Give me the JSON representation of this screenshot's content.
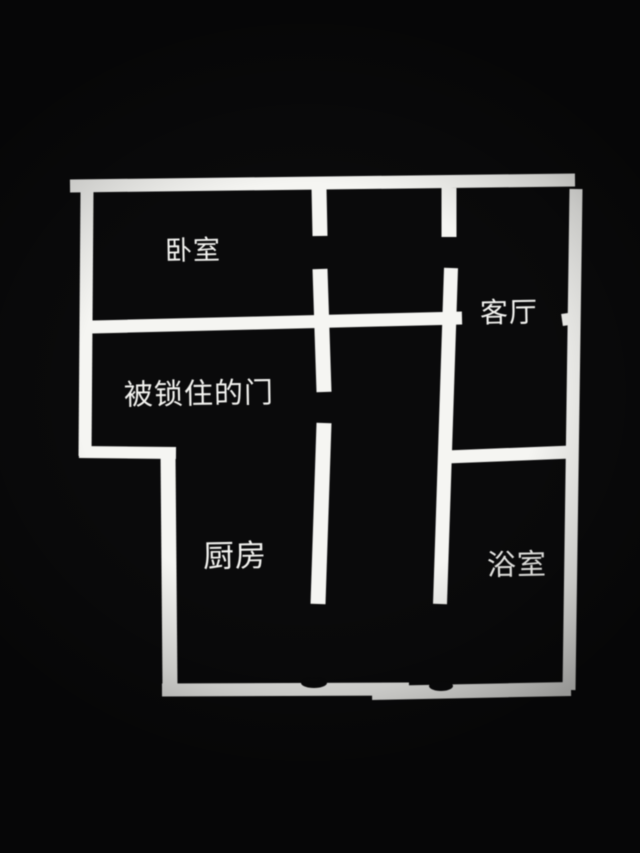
{
  "image": {
    "kind": "floor-plan-photo",
    "width": 640,
    "height": 853,
    "background_color": "#0a0a0b",
    "wall_color": "#f5f5f2",
    "text_color": "#f3f3f0"
  },
  "floor_plan": {
    "rooms": [
      {
        "id": "bedroom",
        "label": "卧室",
        "x": 193,
        "y": 251,
        "font_size": 27
      },
      {
        "id": "living-room",
        "label": "客厅",
        "x": 509,
        "y": 313,
        "font_size": 28
      },
      {
        "id": "locked-door",
        "label": "被锁住的门",
        "x": 199,
        "y": 395,
        "font_size": 29
      },
      {
        "id": "kitchen",
        "label": "厨房",
        "x": 235,
        "y": 556,
        "font_size": 31
      },
      {
        "id": "bathroom",
        "label": "浴室",
        "x": 517,
        "y": 566,
        "font_size": 29
      }
    ],
    "walls": [
      {
        "name": "outer-wall-top",
        "x1": 70,
        "y1": 186,
        "x2": 575,
        "y2": 180,
        "t": 13
      },
      {
        "name": "outer-wall-left",
        "x1": 87,
        "y1": 190,
        "x2": 85,
        "y2": 456,
        "t": 13
      },
      {
        "name": "outer-wall-right",
        "x1": 576,
        "y1": 189,
        "x2": 569,
        "y2": 690,
        "t": 13
      },
      {
        "name": "living-room-wall-stub",
        "x1": 562,
        "y1": 320,
        "x2": 569,
        "y2": 319,
        "t": 12
      },
      {
        "name": "bedroom-east-wall-upper",
        "x1": 319,
        "y1": 188,
        "x2": 320,
        "y2": 236,
        "t": 15
      },
      {
        "name": "bedroom-east-wall-mid",
        "x1": 320,
        "y1": 269,
        "x2": 324,
        "y2": 392,
        "t": 15
      },
      {
        "name": "bedroom-east-wall-lower",
        "x1": 324,
        "y1": 423,
        "x2": 318,
        "y2": 604,
        "t": 15
      },
      {
        "name": "hall-east-wall-upper",
        "x1": 449,
        "y1": 188,
        "x2": 449,
        "y2": 237,
        "t": 15
      },
      {
        "name": "hall-east-wall-lower",
        "x1": 451,
        "y1": 268,
        "x2": 440,
        "y2": 604,
        "t": 14
      },
      {
        "name": "bedroom-south-wall",
        "x1": 92,
        "y1": 327,
        "x2": 462,
        "y2": 318,
        "t": 13
      },
      {
        "name": "locked-room-south-wall",
        "x1": 79,
        "y1": 452,
        "x2": 176,
        "y2": 453,
        "t": 12
      },
      {
        "name": "kitchen-west-wall",
        "x1": 168,
        "y1": 453,
        "x2": 170,
        "y2": 688,
        "t": 15
      },
      {
        "name": "living-bath-divider-wall",
        "x1": 446,
        "y1": 457,
        "x2": 572,
        "y2": 452,
        "t": 13
      },
      {
        "name": "bottom-wall-left-segment",
        "x1": 162,
        "y1": 690,
        "x2": 409,
        "y2": 689,
        "t": 13
      },
      {
        "name": "bottom-wall-right-segment",
        "x1": 372,
        "y1": 693,
        "x2": 571,
        "y2": 689,
        "t": 14
      }
    ],
    "wall_notches": [
      {
        "name": "bottom-wall-notch-left",
        "cx": 314,
        "cy": 683,
        "rx": 13,
        "ry": 5
      },
      {
        "name": "bottom-wall-notch-right",
        "cx": 441,
        "cy": 686,
        "rx": 12,
        "ry": 5
      }
    ],
    "door_openings": [
      {
        "name": "bedroom-door-gap",
        "wall": "bedroom-east-wall",
        "from_y": 236,
        "to_y": 269
      },
      {
        "name": "living-room-door-gap",
        "wall": "hall-east-wall",
        "from_y": 237,
        "to_y": 268
      },
      {
        "name": "locked-door-gap",
        "wall": "bedroom-east-wall",
        "from_y": 392,
        "to_y": 423
      },
      {
        "name": "kitchen-opening",
        "wall": "bedroom-east-wall",
        "from_y": 604,
        "to_y": 683
      },
      {
        "name": "bathroom-opening",
        "wall": "hall-east-wall",
        "from_y": 604,
        "to_y": 683
      }
    ]
  }
}
